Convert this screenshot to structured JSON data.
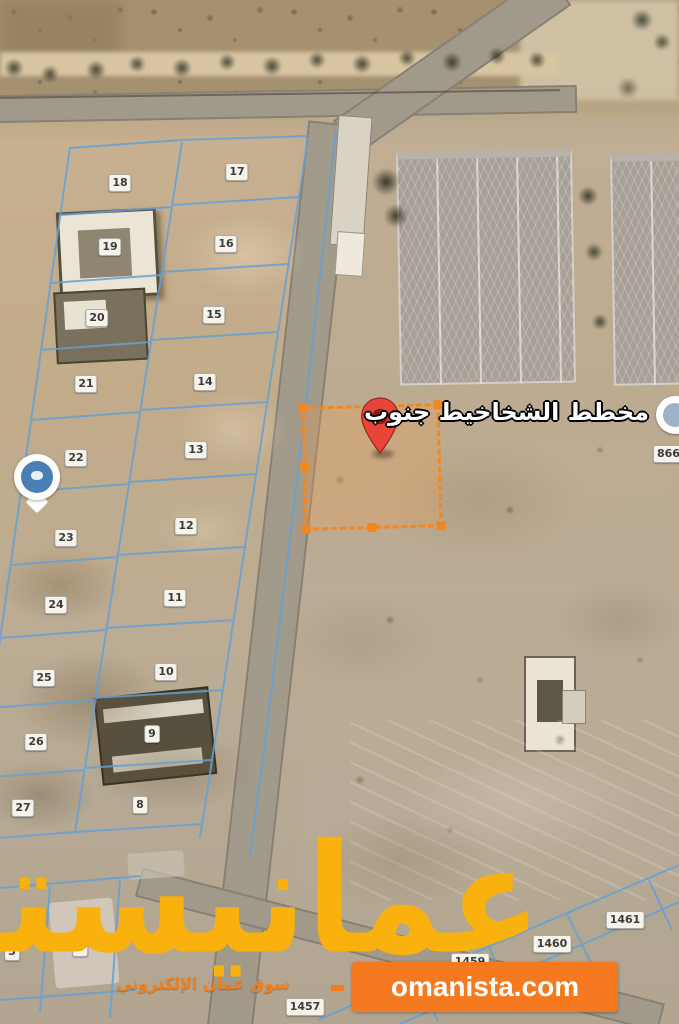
{
  "map": {
    "plan_label": "مخطط الشخاخيط جنوب",
    "partial_badge_right": "866",
    "plot_badges": [
      {
        "label": "18",
        "x": 120,
        "y": 183
      },
      {
        "label": "17",
        "x": 237,
        "y": 172
      },
      {
        "label": "19",
        "x": 110,
        "y": 247
      },
      {
        "label": "16",
        "x": 226,
        "y": 244
      },
      {
        "label": "20",
        "x": 97,
        "y": 318
      },
      {
        "label": "15",
        "x": 214,
        "y": 315
      },
      {
        "label": "21",
        "x": 86,
        "y": 384
      },
      {
        "label": "14",
        "x": 205,
        "y": 382
      },
      {
        "label": "22",
        "x": 76,
        "y": 458
      },
      {
        "label": "13",
        "x": 196,
        "y": 450
      },
      {
        "label": "23",
        "x": 66,
        "y": 538
      },
      {
        "label": "12",
        "x": 186,
        "y": 526
      },
      {
        "label": "24",
        "x": 56,
        "y": 605
      },
      {
        "label": "11",
        "x": 175,
        "y": 598
      },
      {
        "label": "25",
        "x": 44,
        "y": 678
      },
      {
        "label": "10",
        "x": 166,
        "y": 672
      },
      {
        "label": "26",
        "x": 36,
        "y": 742
      },
      {
        "label": "9",
        "x": 152,
        "y": 734
      },
      {
        "label": "27",
        "x": 23,
        "y": 808
      },
      {
        "label": "8",
        "x": 140,
        "y": 805
      },
      {
        "label": "5",
        "x": 12,
        "y": 952
      },
      {
        "label": "6",
        "x": 80,
        "y": 948
      },
      {
        "label": "1461",
        "x": 625,
        "y": 920
      },
      {
        "label": "1460",
        "x": 552,
        "y": 944
      },
      {
        "label": "1459",
        "x": 470,
        "y": 962
      },
      {
        "label": "1457",
        "x": 305,
        "y": 1007
      }
    ]
  },
  "watermark": {
    "brand_arabic": "عمانيستا",
    "tagline_arabic": "سوق عمان الإلكتروني",
    "site_badge": "omanista.com"
  },
  "colors": {
    "highlight_orange": "#F0871F",
    "pin_red": "#E8443A",
    "brand_amber": "#F9B10E",
    "badge_orange": "#F4791F",
    "plot_line_blue": "#65A0D6"
  }
}
